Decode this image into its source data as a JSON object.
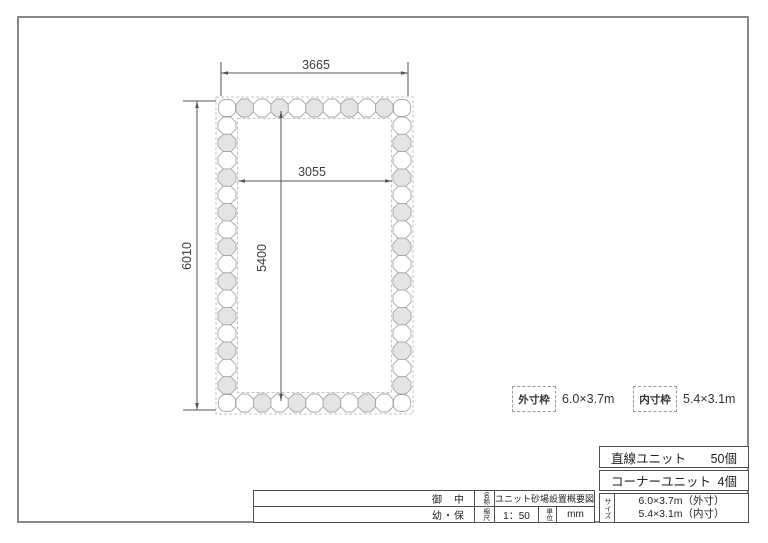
{
  "drawing": {
    "dims": {
      "outer_width": "3665",
      "outer_height": "6010",
      "inner_width": "3055",
      "inner_height": "5400"
    },
    "ring": {
      "top_units": 9,
      "side_units": 16,
      "unit_fill_gray": "#e4e4e4",
      "unit_fill_white": "#ffffff",
      "unit_stroke": "#a6a6a6",
      "boundary_color": "#c4c4c4",
      "dim_line_color": "#555555"
    },
    "legend": {
      "outer_label": "外寸枠",
      "outer_value": "6.0×3.7m",
      "inner_label": "内寸枠",
      "inner_value": "5.4×3.1m"
    }
  },
  "parts_table": {
    "rows": [
      {
        "label": "直線ユニット",
        "qty": "50個"
      },
      {
        "label": "コーナーユニット",
        "qty": "4個"
      }
    ],
    "size_header": "サイズ",
    "size_line1": "6.0×3.7m（外寸）",
    "size_line2": "5.4×3.1m（内寸）"
  },
  "title_block": {
    "client_suffix": "御　中",
    "client_sub": "幼・保",
    "name_label": "名称",
    "name_value": "ユニット砂場設置概要図",
    "scale_label": "縮尺",
    "scale_value": "1：50",
    "unit_label": "単位",
    "unit_value": "mm"
  }
}
